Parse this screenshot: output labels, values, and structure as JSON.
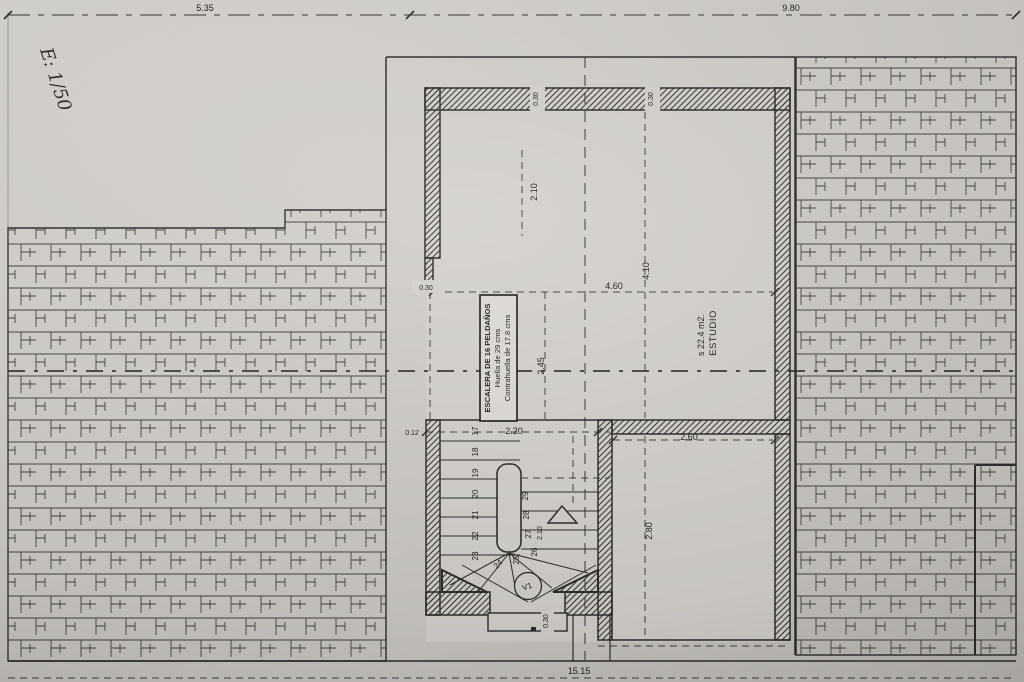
{
  "plan": {
    "scale_note": "E: 1/50",
    "dims": {
      "span_left": "5.35",
      "span_right": "9.80",
      "wall_a": "0.30",
      "wall_b": "0.30",
      "upper": "2.10",
      "left_wall": "0.30",
      "studio_h": "4.10",
      "studio_w": "4.60",
      "stair_h": "2.45",
      "stair_off": "0.12",
      "stair_w": "2.20",
      "lower_w": "2.60",
      "lower_h": "2.80",
      "flight": "2.10",
      "door": "0.30",
      "total": "15.15"
    },
    "room": {
      "name": "ESTUDIO",
      "area": "s 22.4 m2."
    },
    "stair_note": {
      "line1": "ESCALERA DE 16 PELDAÑOS",
      "line2": "Huella de 29 cms",
      "line3": "Contrahuella de 17.8 cms"
    },
    "stairs": {
      "steps": [
        "17",
        "18",
        "19",
        "20",
        "21",
        "22",
        "23",
        "24",
        "25",
        "26",
        "27",
        "28",
        "29"
      ],
      "vent": "V1"
    },
    "colors": {
      "paper": "#cfccc8",
      "ink": "#2e2d2b",
      "hatch": "#45433f"
    }
  }
}
